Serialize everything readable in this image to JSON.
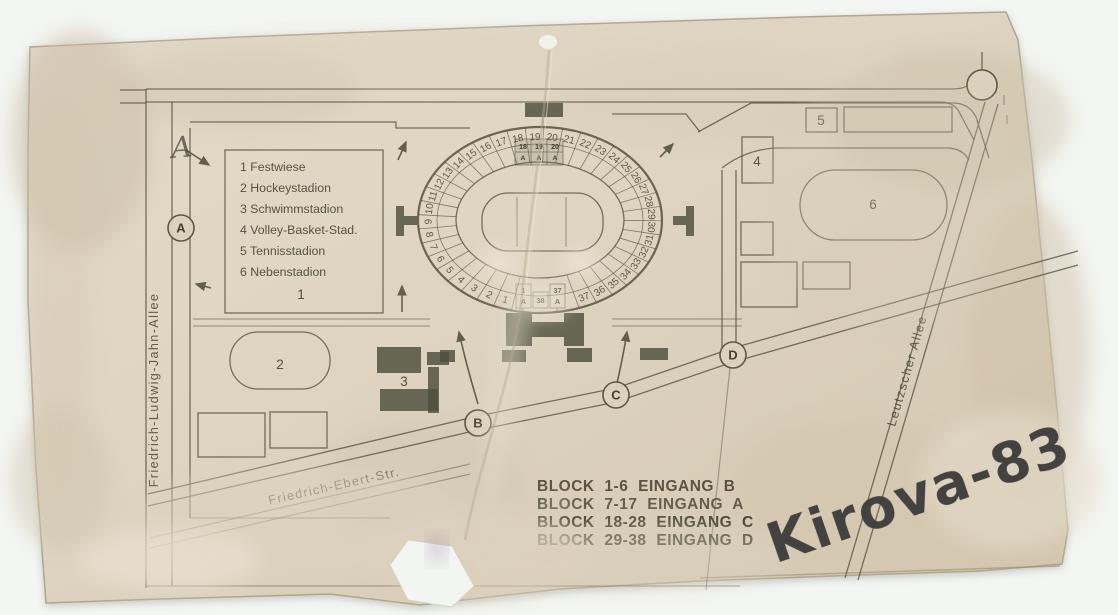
{
  "watermark": {
    "text": "Kirova-83",
    "color": "#3a3a3a"
  },
  "legend": {
    "items": [
      "1 Festwiese",
      "2 Hockeystadion",
      "3 Schwimmstadion",
      "4 Volley-Basket-Stad.",
      "5 Tennisstadion",
      "6 Nebenstadion"
    ]
  },
  "streets": {
    "left_vertical": "Friedrich-Ludwig-Jahn-Allee",
    "bottom_diagonal": "Friedrich-Ebert-Str.",
    "right_diagonal": "Leutzscher Allee"
  },
  "entrance_notes": {
    "lines": [
      "BLOCK 1-6 EINGANG B",
      "BLOCK 7-17 EINGANG A",
      "BLOCK 18-28 EINGANG C",
      "BLOCK 29-38 EINGANG D"
    ]
  },
  "gates": {
    "a": "A",
    "b": "B",
    "c": "C",
    "d": "D"
  },
  "areas": {
    "festwiese": "1",
    "hockeystadion": "2",
    "schwimmstadion": "3",
    "volley_basket": "4",
    "tennisstadion": "5",
    "nebenstadion": "6"
  },
  "stadium": {
    "ring_blocks": [
      "1",
      "2",
      "3",
      "4",
      "5",
      "6",
      "7",
      "8",
      "9",
      "10",
      "11",
      "12",
      "13",
      "14",
      "15",
      "16",
      "17",
      "18",
      "19",
      "20",
      "21",
      "22",
      "23",
      "24",
      "25",
      "26",
      "27",
      "28",
      "29",
      "30",
      "31",
      "32",
      "33",
      "34",
      "35",
      "36",
      "37"
    ],
    "gate_top": {
      "row1": [
        "18",
        "19",
        "20"
      ],
      "row2": [
        "A",
        "A",
        "A"
      ]
    },
    "gate_bottom": {
      "left_num": "1",
      "left_letter": "A",
      "center": "38",
      "right_num": "37",
      "right_letter": "A"
    }
  },
  "annotations": {
    "handwritten_letter": "A"
  },
  "colors": {
    "paper": "#ddd3c0",
    "ink": "#56523f",
    "dark_fill": "#4d4e3d",
    "background": "#f4f6f3"
  }
}
